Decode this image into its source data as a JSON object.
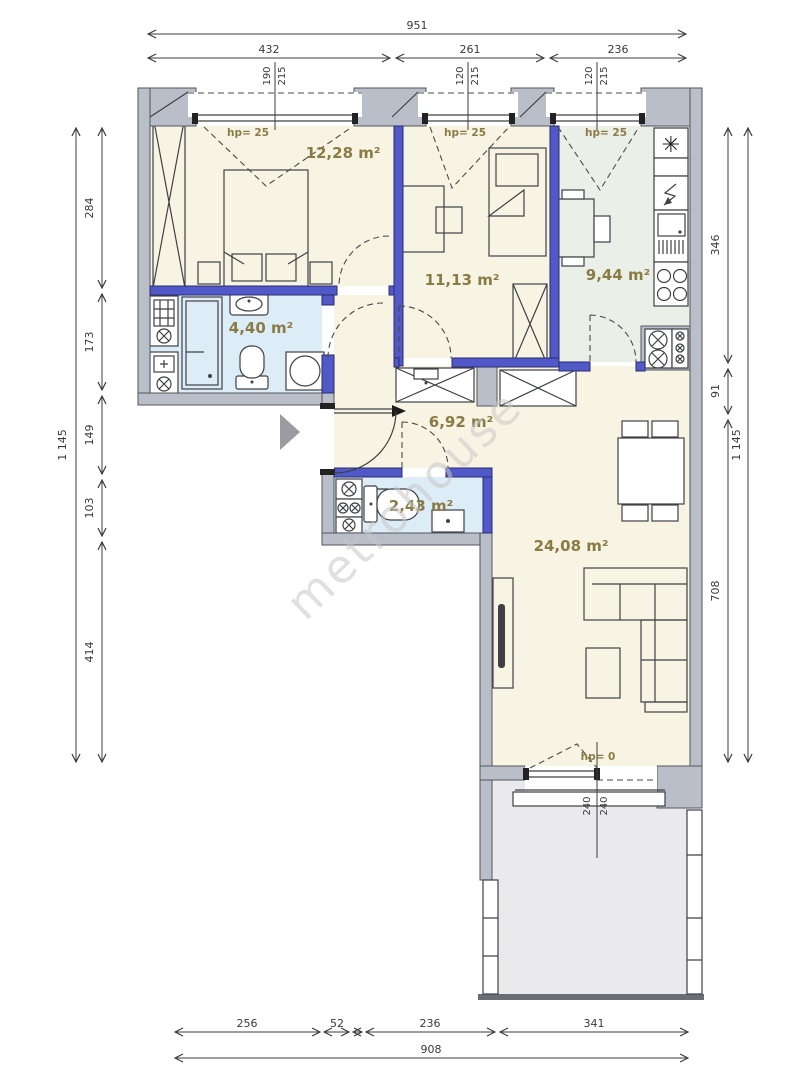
{
  "plan": {
    "rooms": {
      "bedroom": {
        "area": "12,28 m²"
      },
      "room": {
        "area": "11,13 m²"
      },
      "kitchen": {
        "area": "9,44 m²"
      },
      "bathroom": {
        "area": "4,40 m²"
      },
      "hall": {
        "area": "6,92 m²"
      },
      "wc": {
        "area": "2,43 m²"
      },
      "living": {
        "area": "24,08 m²"
      }
    },
    "window_labels": {
      "hp25": "hp= 25",
      "hp0": "hp= 0"
    },
    "watermark": "metrohouse",
    "icons": {
      "fridge_glyph": "✳"
    },
    "dims": {
      "top_total": "951",
      "top_segs": [
        "432",
        "261",
        "236"
      ],
      "win_pairs": [
        [
          "190",
          "215"
        ],
        [
          "120",
          "215"
        ],
        [
          "120",
          "215"
        ]
      ],
      "left_total": "1 145",
      "left_segs": [
        "284",
        "173",
        "149",
        "103",
        "414"
      ],
      "right_total": "1 145",
      "right_segs": [
        "346",
        "91",
        "708"
      ],
      "bottom_total": "908",
      "bottom_segs": [
        "256",
        "52",
        "236",
        "341"
      ],
      "balcony_pair": [
        "240",
        "240"
      ]
    },
    "colors": {
      "wall_exterior": "#b9bec8",
      "wall_interior": "#5158c7",
      "room_cream": "#f8f4e3",
      "room_kitchen": "#eaf0e7",
      "room_wet": "#ddedf8",
      "balcony": "#eaeaed",
      "label_olive": "#8a7b45"
    }
  }
}
